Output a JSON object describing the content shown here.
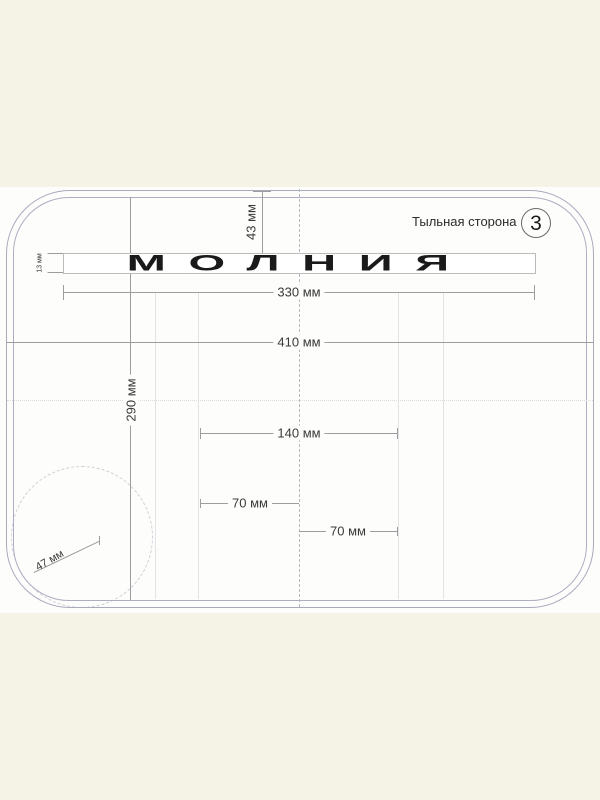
{
  "header": {
    "side_label": "Тыльная сторона",
    "sheet_number": "3"
  },
  "artwork": {
    "zipper_text": "МОЛНИЯ"
  },
  "dimensions": {
    "top_to_zipper": "43 мм",
    "zipper_height": "13 мм",
    "zipper_width": "330 мм",
    "overall_width": "410 мм",
    "overall_height": "290 мм",
    "center_pocket_width": "140 мм",
    "pocket_left_half": "70 мм",
    "pocket_right_half": "70 мм",
    "corner_radius": "47 мм"
  },
  "colors": {
    "canvas_background": "#f5f3e6",
    "sheet_background": "#fdfdfb",
    "outline": "#a9a9bd",
    "dimension_line": "#9d9d9d",
    "dimension_text": "#3a3a3a",
    "zipper_text_color": "#1a1a1a"
  }
}
